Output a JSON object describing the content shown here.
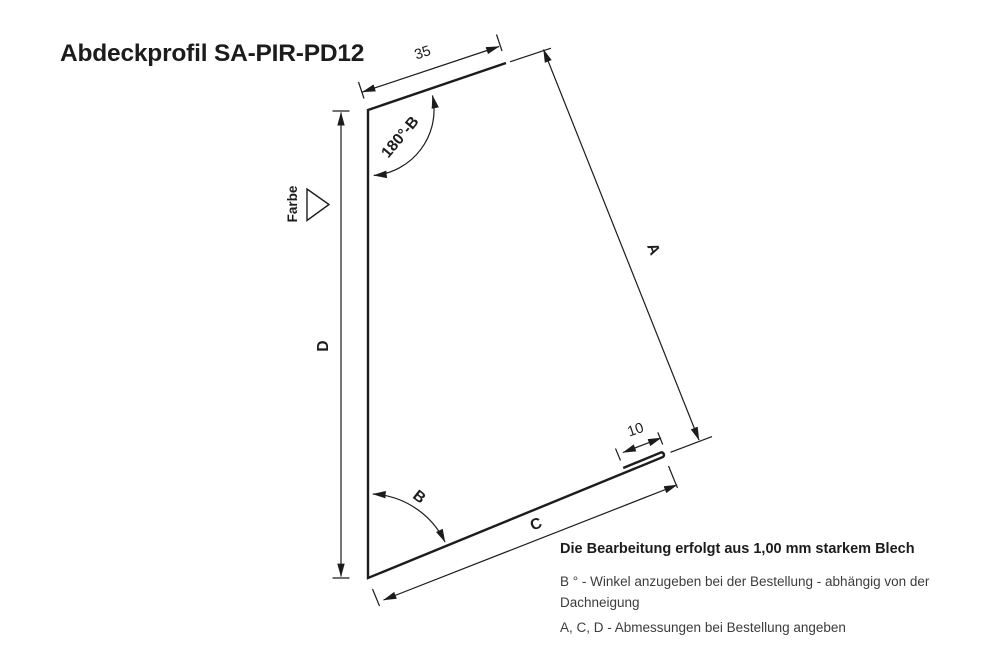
{
  "title": "Abdeckprofil SA-PIR-PD12",
  "colors": {
    "line": "#1c1c1c",
    "note_text": "#3c3c3c",
    "background": "#ffffff"
  },
  "dimensions": {
    "top_flange": "35",
    "top_angle": "180°-B",
    "color_marker": "Farbe",
    "height": "D",
    "slant_side": "A",
    "hem": "10",
    "bottom_angle": "B",
    "bottom_side": "C"
  },
  "notes": {
    "material": "Die Bearbeitung erfolgt aus 1,00 mm starkem Blech",
    "angle_note": "B ° - Winkel anzugeben bei der Bestellung - abhängig von der Dachneigung",
    "dimensions_note": "A, C, D - Abmessungen bei Bestellung angeben"
  }
}
